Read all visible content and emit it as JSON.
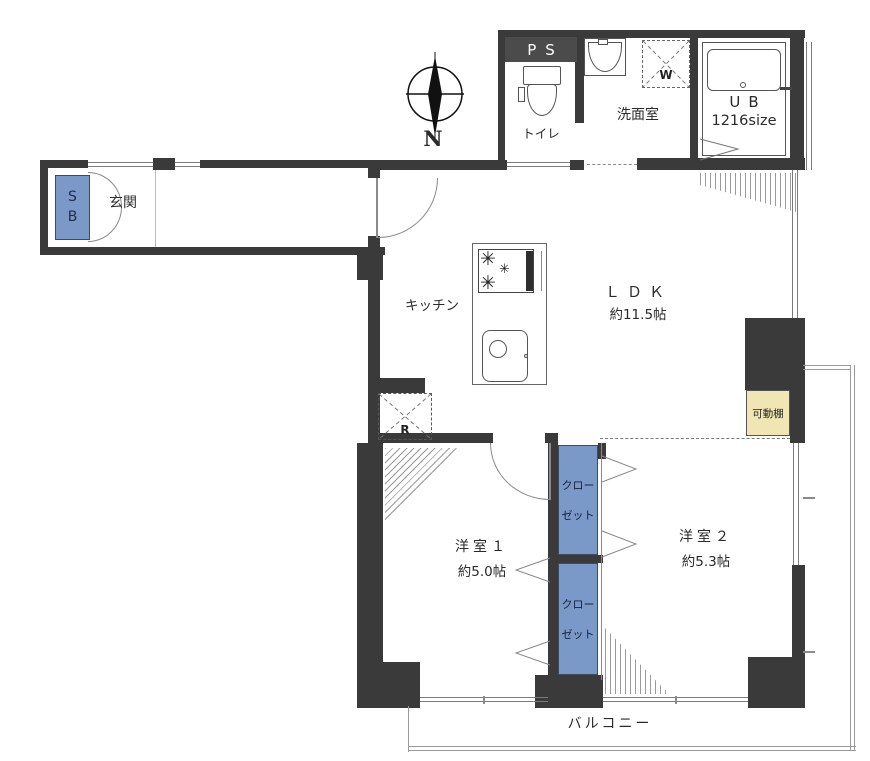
{
  "floorplan": {
    "compass": {
      "north_label": "N"
    },
    "labels": {
      "ps": "PS",
      "toilet": "トイレ",
      "washroom": "洗面室",
      "washer": "W",
      "bath_type": "UB",
      "bath_size": "1216size",
      "sb_line1": "S",
      "sb_line2": "B",
      "entrance": "玄関",
      "kitchen": "キッチン",
      "ldk_name": "ＬＤＫ",
      "ldk_size": "約11.5帖",
      "fridge": "R",
      "movable_shelf": "可動棚",
      "room1_name": "洋室１",
      "room1_size": "約5.0帖",
      "room2_name": "洋室２",
      "room2_size": "約5.3帖",
      "closet1_line1": "クロー",
      "closet1_line2": "ゼット",
      "closet2_line1": "クロー",
      "closet2_line2": "ゼット",
      "balcony": "バルコニー"
    },
    "colors": {
      "wall": "#3a3a3a",
      "closet_fill": "#7b99c8",
      "shelf_fill": "#f0e6b4",
      "ps_fill": "#4b4b4b"
    }
  }
}
